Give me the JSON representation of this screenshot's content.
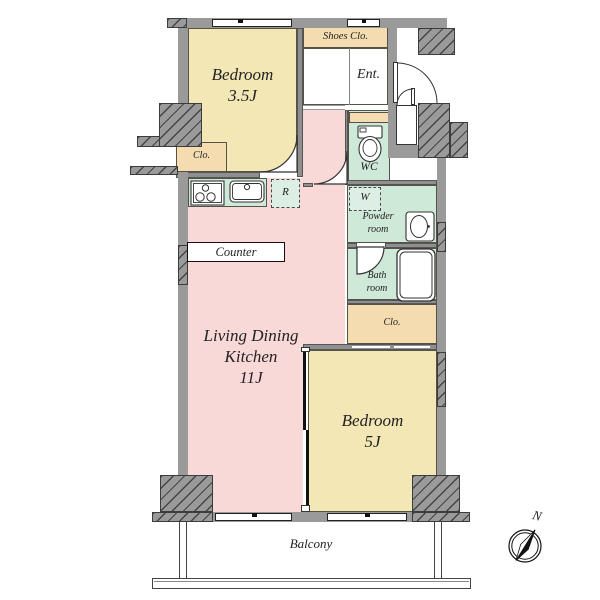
{
  "plan": {
    "rooms": {
      "bedroom_35": {
        "name": "Bedroom",
        "size": "3.5J"
      },
      "closet_bedroom_35": {
        "label": "Clo."
      },
      "shoes_closet": {
        "label": "Shoes Clo."
      },
      "entrance": {
        "label": "Ent."
      },
      "wc": {
        "label": "WC"
      },
      "powder_room": {
        "line1": "Powder",
        "line2": "room"
      },
      "bath_room": {
        "line1": "Bath",
        "line2": "room"
      },
      "closet_hall": {
        "label": "Clo."
      },
      "ldk": {
        "line1": "Living Dining",
        "line2": "Kitchen",
        "size": "11J"
      },
      "bedroom_5": {
        "name": "Bedroom",
        "size": "5J"
      },
      "balcony": {
        "label": "Balcony"
      }
    },
    "fixtures": {
      "refrigerator": {
        "label": "R"
      },
      "washer": {
        "label": "W"
      },
      "counter": {
        "label": "Counter"
      }
    },
    "compass": {
      "north": "N"
    },
    "colors": {
      "wall": "#9a9a9a",
      "room_yellow": "#f2e7b5",
      "room_pink": "#f9d8d8",
      "wet_green": "#cfe9d8",
      "closet_tan": "#f4dcb0",
      "dashed_green": "#ddeee4",
      "line": "#333333"
    }
  }
}
